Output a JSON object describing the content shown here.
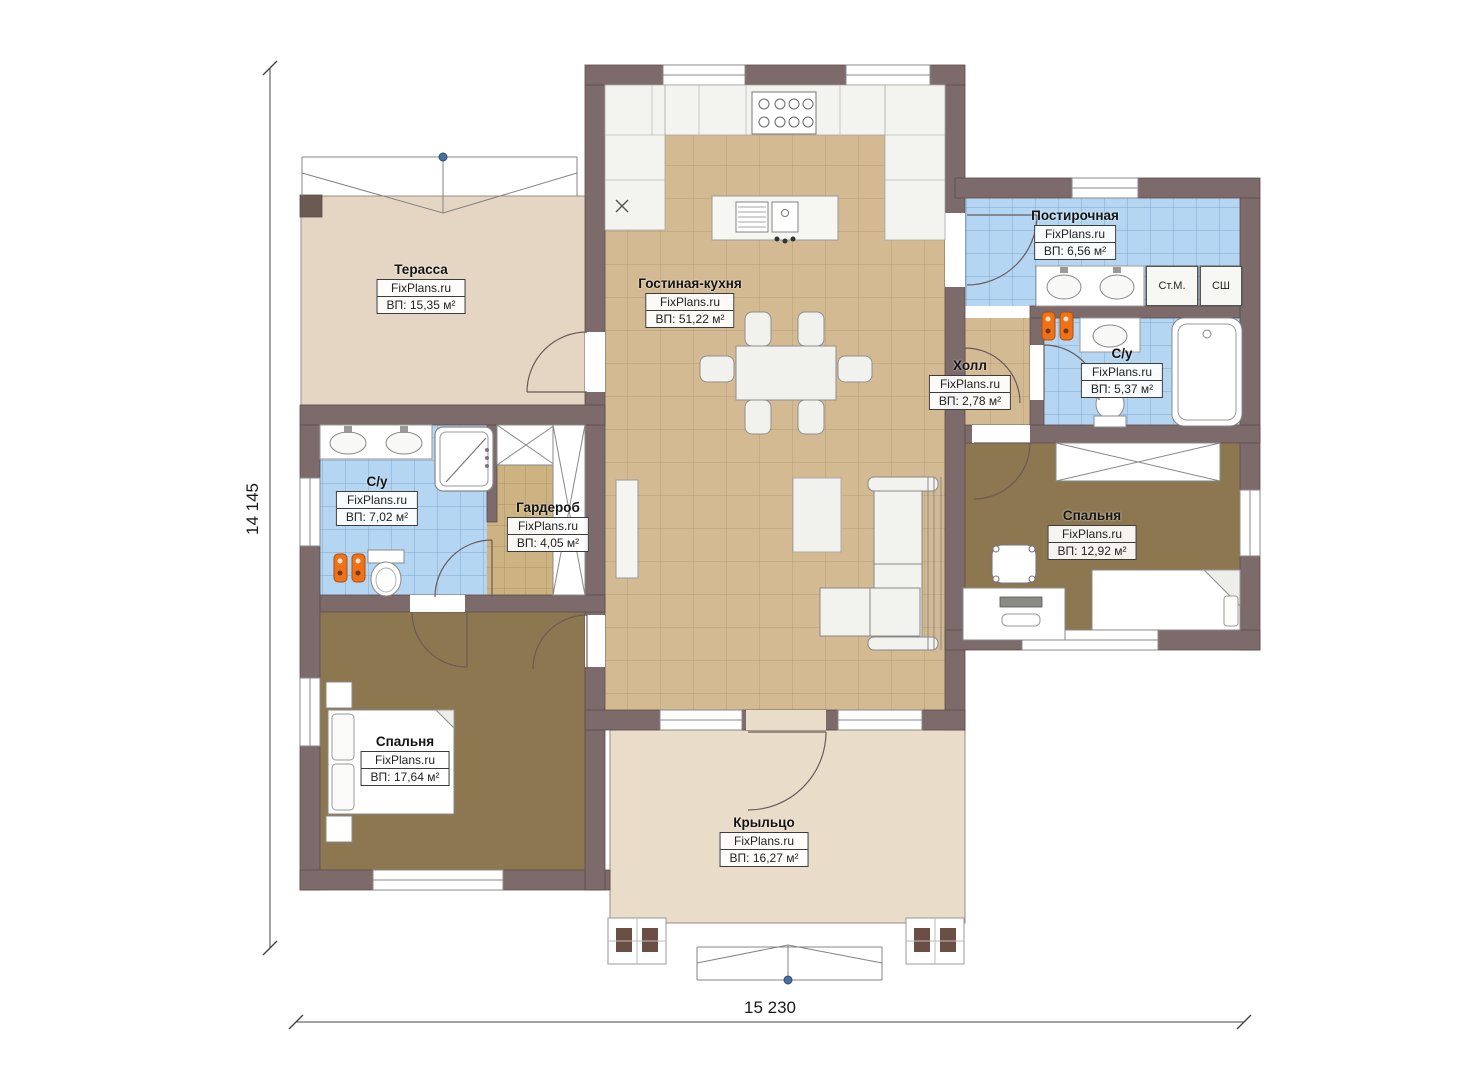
{
  "plan": {
    "watermark": "FixPlans.ru",
    "dimensions": {
      "bottom": "15 230",
      "left": "14 145"
    },
    "rooms": [
      {
        "id": "terrace",
        "name": "Терасса",
        "watermark": "FixPlans.ru",
        "area": "ВП: 15,35 м²"
      },
      {
        "id": "living-kitchen",
        "name": "Гостиная-кухня",
        "watermark": "FixPlans.ru",
        "area": "ВП: 51,22 м²"
      },
      {
        "id": "laundry",
        "name": "Постирочная",
        "watermark": "FixPlans.ru",
        "area": "ВП: 6,56 м²"
      },
      {
        "id": "hall",
        "name": "Холл",
        "watermark": "FixPlans.ru",
        "area": "ВП: 2,78 м²"
      },
      {
        "id": "bathroom-right",
        "name": "С/у",
        "watermark": "FixPlans.ru",
        "area": "ВП: 5,37 м²"
      },
      {
        "id": "bathroom-left",
        "name": "С/у",
        "watermark": "FixPlans.ru",
        "area": "ВП: 7,02 м²"
      },
      {
        "id": "wardrobe-room",
        "name": "Гардероб",
        "watermark": "FixPlans.ru",
        "area": "ВП: 4,05 м²"
      },
      {
        "id": "bedroom-right",
        "name": "Спальня",
        "watermark": "FixPlans.ru",
        "area": "ВП: 12,92 м²"
      },
      {
        "id": "bedroom-left",
        "name": "Спальня",
        "watermark": "FixPlans.ru",
        "area": "ВП: 17,64 м²"
      },
      {
        "id": "porch",
        "name": "Крыльцо",
        "watermark": "FixPlans.ru",
        "area": "ВП: 16,27 м²"
      }
    ],
    "appliances": [
      {
        "label": "Ст.М."
      },
      {
        "label": "СШ"
      }
    ],
    "colors": {
      "wall": "#7d6a6a",
      "tile_tan": "#d4ba92",
      "tile_blue": "#b5d6f2",
      "floor_bedroom": "#8c7750",
      "floor_terrace": "#e4d6c3",
      "floor_porch": "#e9dcc8",
      "accent_orange": "#ed7218",
      "marker_blue": "#4a6fa0"
    }
  }
}
